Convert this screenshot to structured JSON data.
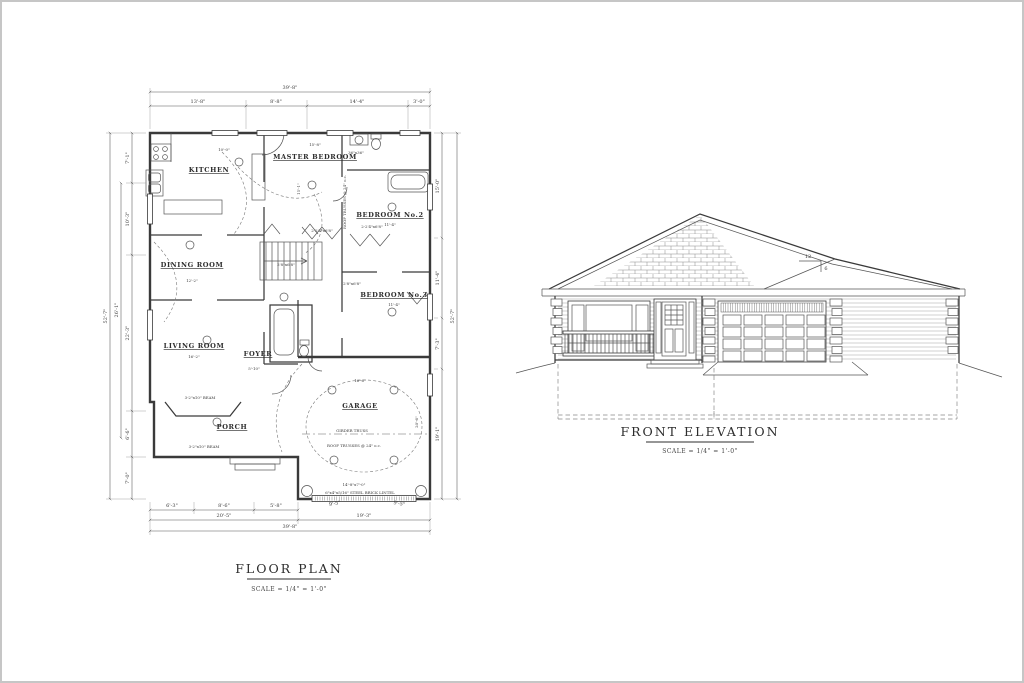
{
  "sheet": {
    "background": "#ffffff",
    "border_color": "#c6c6c6",
    "line_color": "#3a3a3a"
  },
  "floor_plan": {
    "title": "FLOOR PLAN",
    "scale_note": "SCALE = 1/4\" = 1'-0\"",
    "rooms": {
      "kitchen": "KITCHEN",
      "master_bedroom": "MASTER BEDROOM",
      "bedroom2": "BEDROOM No.2",
      "bedroom3": "BEDROOM No.3",
      "dining": "DINING ROOM",
      "living": "LIVING ROOM",
      "foyer": "FOYER",
      "porch": "PORCH",
      "garage": "GARAGE"
    },
    "dims": {
      "top_overall": "39'-8\"",
      "top_chain": [
        "13'-8\"",
        "8'-8\"",
        "14'-4\"",
        "3'-0\""
      ],
      "bottom_chain": [
        "6'-3\"",
        "8'-6\"",
        "5'-8\""
      ],
      "bottom_sub_left": "20'-5\"",
      "bottom_sub_right": "19'-3\"",
      "bottom_overall": "39'-8\"",
      "bottom_garage_left": "9'-5\"",
      "bottom_garage_right": "9'-5\"",
      "left_overall": "52'-7\"",
      "left_sub": "26'-1\"",
      "left_chain": [
        "7'-1\"",
        "10'-3\"",
        "22'-3\"",
        "6'-6\"",
        "7'-0\""
      ],
      "right_overall": "52'-7\"",
      "right_chain": [
        "15'-0\"",
        "11'-4\"",
        "7'-3\"",
        "19'-1\""
      ]
    },
    "interior_dims": {
      "kitchen_w": "10'-0\"",
      "master_w": "15'-8\"",
      "master_d": "15'-1\"",
      "bedroom2_w": "11'-4\"",
      "bedroom3_w": "11'-4\"",
      "dining_w": "12'-2\"",
      "living_w": "16'-2\"",
      "foyer_w": "5'-10\"",
      "garage_w": "16'-6\"",
      "garage_d": "20'-6\""
    },
    "annotations": {
      "roof_trusses": "ROOF TRUSSES @ 24\" o.c.",
      "girder_truss": "GIRDER TRUSS",
      "beam": "3-2\"x10\" BEAM",
      "lintel": "6\"x4\"x5/16\" STEEL BRICK LINTEL",
      "garage_door_size": "14'-8\"x7'-0\"",
      "closet_door": "2-2'4\"x6'8\"",
      "door": "2'8\"x6'8\"",
      "shower": "36\"x36\""
    }
  },
  "elevation": {
    "title": "FRONT ELEVATION",
    "scale_note": "SCALE = 1/4\" = 1'-0\"",
    "pitch_run": "12",
    "pitch_rise": "6"
  }
}
